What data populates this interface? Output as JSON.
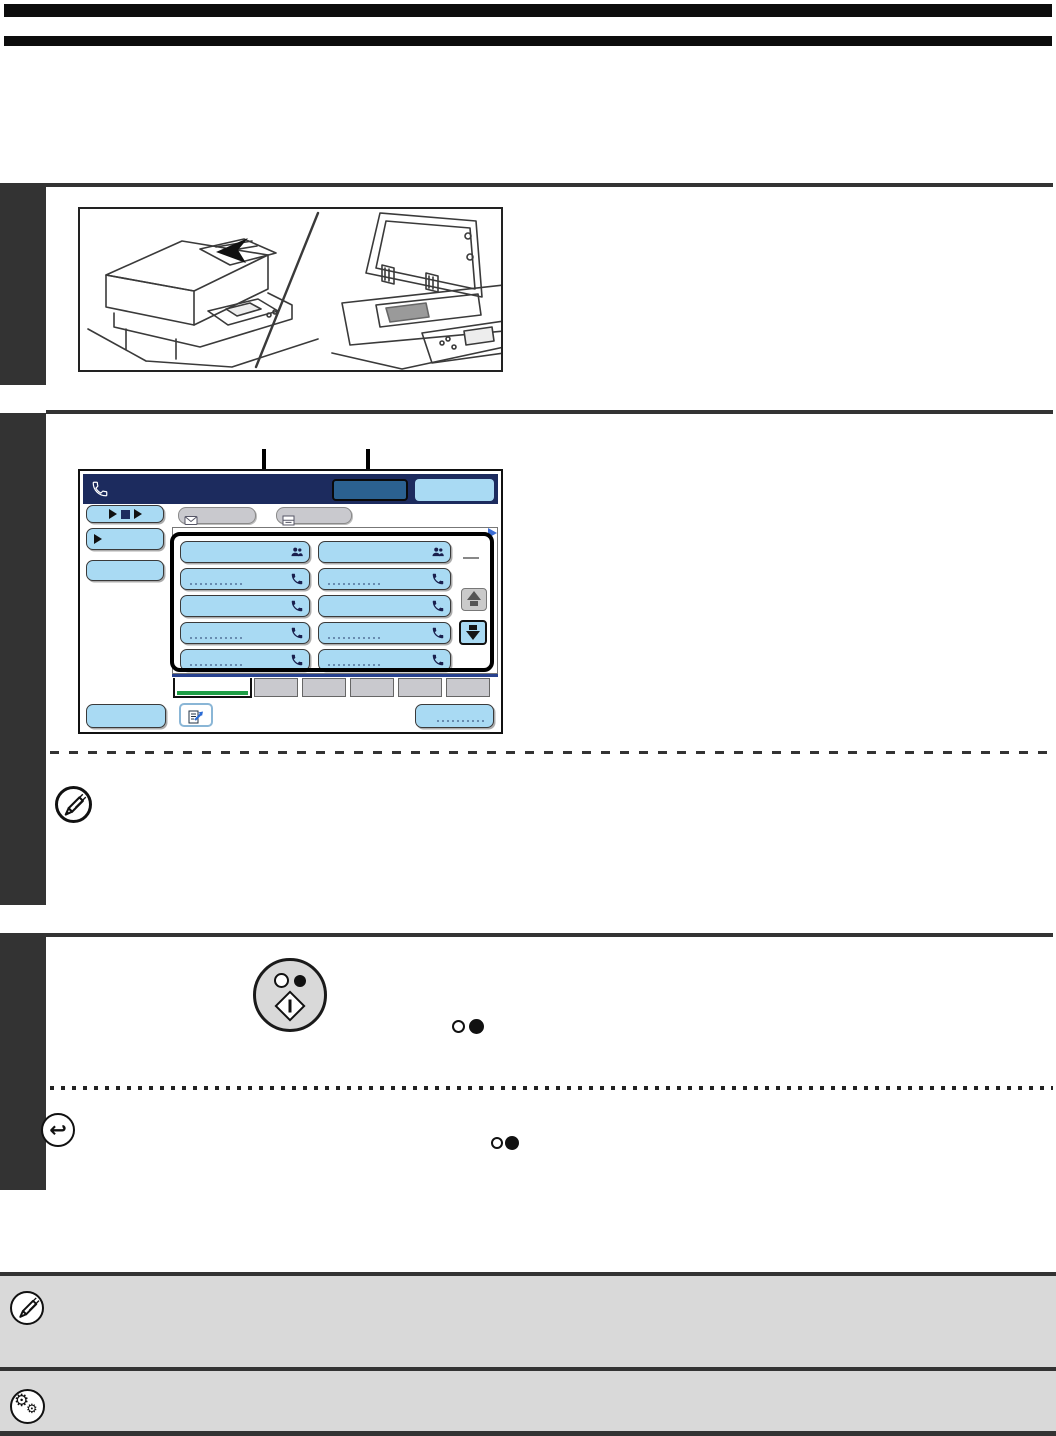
{
  "document_kind": "operation-manual page (no legible body text, illustrations only)",
  "colors": {
    "page_bg": "#ffffff",
    "rule_dark": "#333333",
    "top_bars": "#0d0d0d",
    "navy_header": "#1c2b5e",
    "dark_blue_button": "#2b6190",
    "light_blue_key": "#a9daf3",
    "gray_button": "#c9c9ce",
    "green_tab_indicator": "#1e9e45",
    "blue_line": "#27418f",
    "note_box_gray": "#d9d9d9",
    "icon_navy": "#1a1f4d",
    "arrow_blue": "#2b6bd4"
  },
  "glyphs": {
    "return_arrow": "↩",
    "gear": "⚙",
    "gear_small": "⚙"
  },
  "copier_figure": {
    "left_view": "automatic-document-feeder",
    "right_view": "document-glass-open-cover"
  },
  "callouts": {
    "count": 2,
    "targets": [
      "address-key-panel",
      "header-dark-button"
    ]
  },
  "fax_screen": {
    "header": {
      "icon": "phone-handset-icon",
      "buttons": [
        {
          "style": "dark-blue"
        },
        {
          "style": "light-blue"
        }
      ]
    },
    "left_buttons": [
      {
        "icon": "play-stop-play"
      },
      {
        "icon": "play"
      },
      {
        "icon": "none"
      }
    ],
    "top_gray_buttons": [
      {
        "icon": "envelope"
      },
      {
        "icon": "inbox-document"
      }
    ],
    "address_grid": {
      "columns": 2,
      "rows": [
        {
          "icons": [
            "group",
            "group"
          ],
          "faint": [
            false,
            false
          ]
        },
        {
          "icons": [
            "phone",
            "phone"
          ],
          "faint": [
            true,
            true
          ]
        },
        {
          "icons": [
            "phone",
            "phone"
          ],
          "faint": [
            false,
            false
          ]
        },
        {
          "icons": [
            "phone",
            "phone"
          ],
          "faint": [
            true,
            true
          ]
        },
        {
          "icons": [
            "phone",
            "phone"
          ],
          "faint": [
            true,
            true
          ]
        }
      ]
    },
    "scroll_buttons": {
      "up": "gray-disabled",
      "down": "blue-enabled"
    },
    "tabs": {
      "selected_index": 0,
      "selected_style": "white-with-green-underline",
      "gray_count": 5
    },
    "bottom_buttons": [
      {
        "type": "plain"
      },
      {
        "type": "icon",
        "icon": "compose-forward"
      },
      {
        "type": "plain-faint-label"
      }
    ]
  },
  "hardware_keys": {
    "start_key_symbols": [
      "white-circle",
      "black-circle",
      "start-diamond"
    ],
    "inline_symbol_pairs": 2
  },
  "margin_icons": [
    {
      "icon": "note-pencil-icon"
    },
    {
      "icon": "return-arrow-icon"
    }
  ],
  "footer_notes": [
    {
      "icon": "note-pencil-icon"
    },
    {
      "icon": "settings-gears-icon"
    }
  ]
}
